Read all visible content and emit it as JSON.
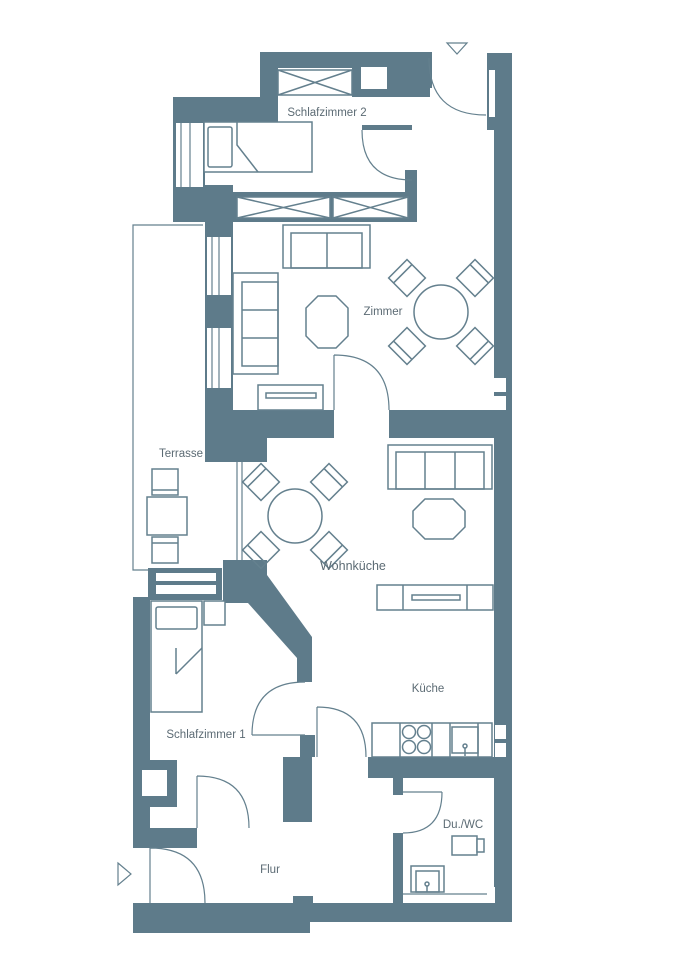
{
  "plan": {
    "type": "apartment-floor-plan",
    "rooms": [
      {
        "id": "schlafzimmer2",
        "label": "Schlafzimmer 2"
      },
      {
        "id": "zimmer",
        "label": "Zimmer"
      },
      {
        "id": "terrasse",
        "label": "Terrasse"
      },
      {
        "id": "wohnkueche",
        "label": "Wohnküche"
      },
      {
        "id": "schlafzimmer1",
        "label": "Schlafzimmer 1"
      },
      {
        "id": "kueche",
        "label": "Küche"
      },
      {
        "id": "duwc",
        "label": "Du./WC"
      },
      {
        "id": "flur",
        "label": "Flur"
      }
    ],
    "furniture": [
      "single-bed x2",
      "wardrobe x3",
      "sofa-2seat",
      "sofa-3seat x2",
      "coffee-table x2",
      "round-dining-table-4-chairs x2",
      "sideboard x2",
      "terrace-table-2-chairs",
      "kitchen-counter-stove-sink",
      "wc",
      "shower"
    ],
    "markers": [
      "entrance-arrow-top",
      "entrance-arrow-bottom"
    ],
    "colors": {
      "wall": "#5E7B8A",
      "furniture_line": "#64808E",
      "label_text": "#5C6B74",
      "background": "#FFFFFF"
    }
  }
}
